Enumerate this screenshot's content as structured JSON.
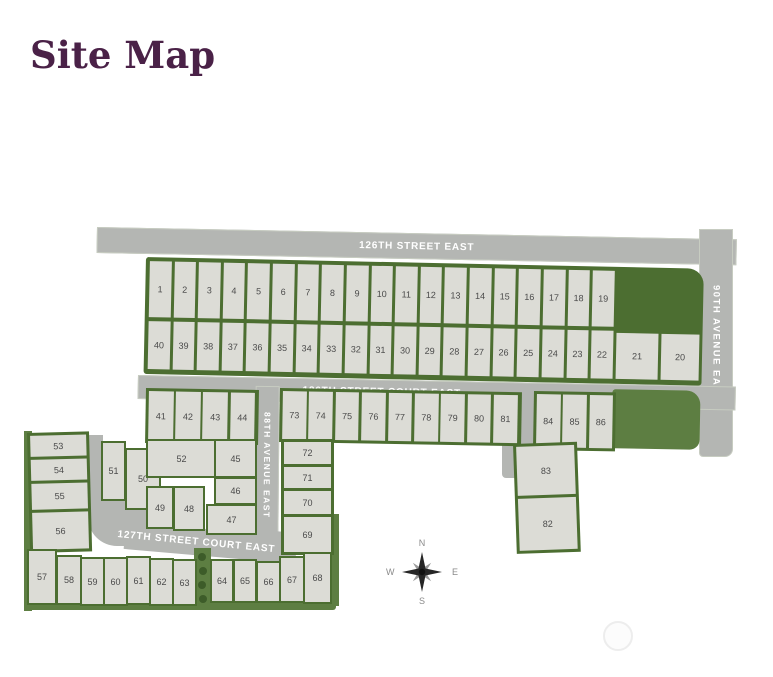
{
  "page": {
    "title": "Site Map"
  },
  "colors": {
    "title_text": "#4a2147",
    "street_fill": "#b4b6b3",
    "street_label": "#ffffff",
    "lot_fill": "#dcdcd6",
    "lot_border_green": "#4c6e31",
    "green_space": "#5d7e42",
    "tree_green": "#3d5c29",
    "lot_number_text": "#4a4a4a",
    "compass_text": "#8a8a8a"
  },
  "streets": {
    "street_126_east": "126TH STREET EAST",
    "street_126_court_east": "126TH STREET COURT EAST",
    "street_127_court_east": "127TH STREET COURT EAST",
    "avenue_88_east": "88TH AVENUE EAST",
    "avenue_90_east": "90TH AVENUE EAST"
  },
  "compass": {
    "n": "N",
    "e": "E",
    "s": "S",
    "w": "W"
  },
  "lots": {
    "row_north": [
      "1",
      "2",
      "3",
      "4",
      "5",
      "6",
      "7",
      "8",
      "9",
      "10",
      "11",
      "12",
      "13",
      "14",
      "15",
      "16",
      "17",
      "18",
      "19"
    ],
    "row_south": [
      "40",
      "39",
      "38",
      "37",
      "36",
      "35",
      "34",
      "33",
      "32",
      "31",
      "30",
      "29",
      "28",
      "27",
      "26",
      "25",
      "24",
      "23",
      "22"
    ],
    "east_pair": [
      "21",
      "20"
    ],
    "row_41_44": [
      "41",
      "42",
      "43",
      "44"
    ],
    "row_73_81": [
      "73",
      "74",
      "75",
      "76",
      "77",
      "78",
      "79",
      "80",
      "81"
    ],
    "row_84_86": [
      "84",
      "85",
      "86"
    ],
    "southeast_pair": [
      "83",
      "82"
    ],
    "west_col": [
      "53",
      "54",
      "55",
      "56"
    ],
    "cluster": [
      "51",
      "50",
      "52",
      "49",
      "48",
      "45",
      "46",
      "47"
    ],
    "col_72_69": [
      "72",
      "71",
      "70",
      "69"
    ],
    "bottom_west": [
      "57",
      "58",
      "59",
      "60",
      "61",
      "62",
      "63"
    ],
    "bottom_east": [
      "64",
      "65",
      "66",
      "67",
      "68"
    ]
  }
}
